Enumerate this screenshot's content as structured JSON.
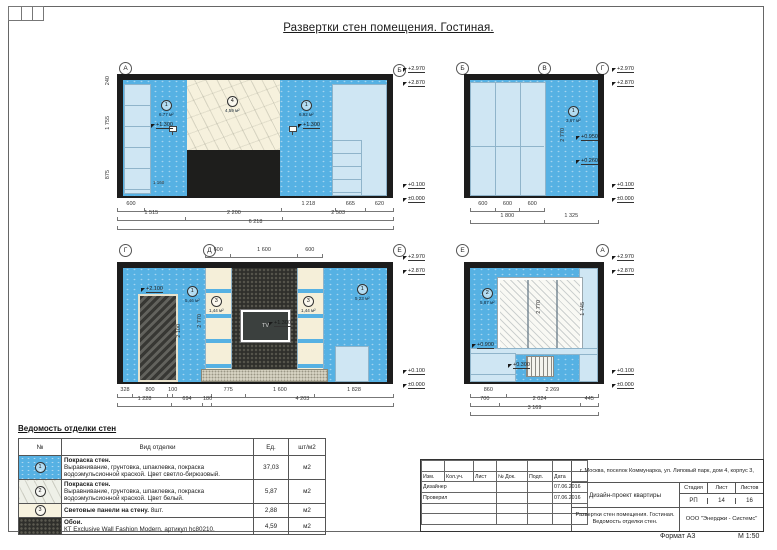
{
  "sheet": {
    "title": "Развертки стен помещения. Гостиная.",
    "format": "Формат А3",
    "scale": "М 1:50"
  },
  "elev1": {
    "markerL": "А",
    "markerR": "Б",
    "zoneL": {
      "num": "1",
      "area": "6,77 м²"
    },
    "zoneC": {
      "num": "4",
      "area": "4,59 м²"
    },
    "zoneR": {
      "num": "1",
      "area": "6,92 м²"
    },
    "lampL": "+1.300",
    "lampR": "+1.300",
    "innerdim": "1 160",
    "marks": [
      "+2.970",
      "+2.870",
      "+0.100",
      "±0.000"
    ],
    "vdims": [
      "240",
      "1 755",
      "875"
    ],
    "dims1": [
      "600",
      "",
      "1 218",
      "665",
      "620"
    ],
    "dims2": [
      "1 515",
      "2 200",
      "2 503"
    ],
    "total": "6 218"
  },
  "elev2": {
    "markerL": "Б",
    "markerC": "В",
    "markerR": "Г",
    "zone": {
      "num": "1",
      "area": "3,67 м²"
    },
    "vdim": "2 770",
    "marks": [
      "+2.970",
      "+2.870",
      "+0.950",
      "+0.260",
      "+0.100",
      "±0.000"
    ],
    "dims1": [
      "600",
      "600",
      "600"
    ],
    "dims2": [
      "1 800",
      "1 325"
    ]
  },
  "elev3": {
    "markerL": "Г",
    "markerC": "Д",
    "markerR": "Е",
    "topdims": [
      "600",
      "1 600",
      "600"
    ],
    "doormark": "+2.100",
    "doordim": "2 100",
    "vdim": "2 770",
    "zoneL": {
      "num": "1",
      "area": "5,46 м²"
    },
    "zoneR": {
      "num": "1",
      "area": "5,23 м²"
    },
    "panelL": {
      "num": "3",
      "area": "1,44 м²"
    },
    "panelR": {
      "num": "3",
      "area": "1,44 м²"
    },
    "tv": "TV",
    "tvmark": "+1.300",
    "marks": [
      "+2.970",
      "+2.870",
      "+0.100",
      "±0.000"
    ],
    "dims1": [
      "328",
      "800",
      "100",
      "",
      "775",
      "1 600",
      "1 828"
    ],
    "dims2": [
      "1 228",
      "694",
      "180",
      "4 203"
    ]
  },
  "elev4": {
    "markerL": "Е",
    "markerR": "А",
    "zone": {
      "num": "2",
      "area": "5,87 м²"
    },
    "vdim": "2 770",
    "windim": "1 745",
    "sillmark": "+0.900",
    "radmark": "+0.300",
    "marks": [
      "+2.970",
      "+2.870",
      "+0.100",
      "±0.000"
    ],
    "dims1": [
      "860",
      "2 269"
    ],
    "dims2": [
      "700",
      "2 024",
      "445"
    ],
    "total": "3 169"
  },
  "legend": {
    "title": "Ведомость отделки стен",
    "headers": [
      "№",
      "Вид отделки",
      "Ед.",
      "шт/м2"
    ],
    "rows": [
      {
        "num": "1",
        "name": "Покраска стен.",
        "desc": "Выравнивание, грунтовка, шпаклевка, покраска водоэмульсионной краской. Цвет светло-бирюзовый.",
        "qty": "37,03",
        "unit": "м2"
      },
      {
        "num": "2",
        "name": "Покраска стен.",
        "desc": "Выравнивание, грунтовка, шпаклевка, покраска водоэмульсионной краской. Цвет белый.",
        "qty": "5,87",
        "unit": "м2"
      },
      {
        "num": "3",
        "name": "Световые панели на стену.",
        "desc": "8шт.",
        "qty": "2,88",
        "unit": "м2"
      },
      {
        "num": "",
        "name": "Обои.",
        "desc": "КТ Exclusive Wall Fashion Modern.  артикул hc80210.",
        "qty": "4,59",
        "unit": "м2"
      }
    ]
  },
  "titleblock": {
    "address": "г. Москва, поселок Коммунарка, ул. Липовый парк, дом 4, корпус 3,",
    "columns": [
      "Изм.",
      "Кол.уч.",
      "Лист",
      "№ Док.",
      "Подп.",
      "Дата"
    ],
    "rows": [
      {
        "role": "Дизайнер",
        "date": "07.06.2016"
      },
      {
        "role": "Проверил",
        "date": "07.06.2016"
      }
    ],
    "project": "Дизайн-проект квартиры",
    "stage_headers": [
      "Стадия",
      "Лист",
      "Листов"
    ],
    "stage_values": [
      "РП",
      "14",
      "16"
    ],
    "sheet_name1": "Развертки стен помещения. Гостиная.",
    "sheet_name2": "Ведомость отделки стен.",
    "company": "ООО \"Энерджи - Системс\""
  }
}
